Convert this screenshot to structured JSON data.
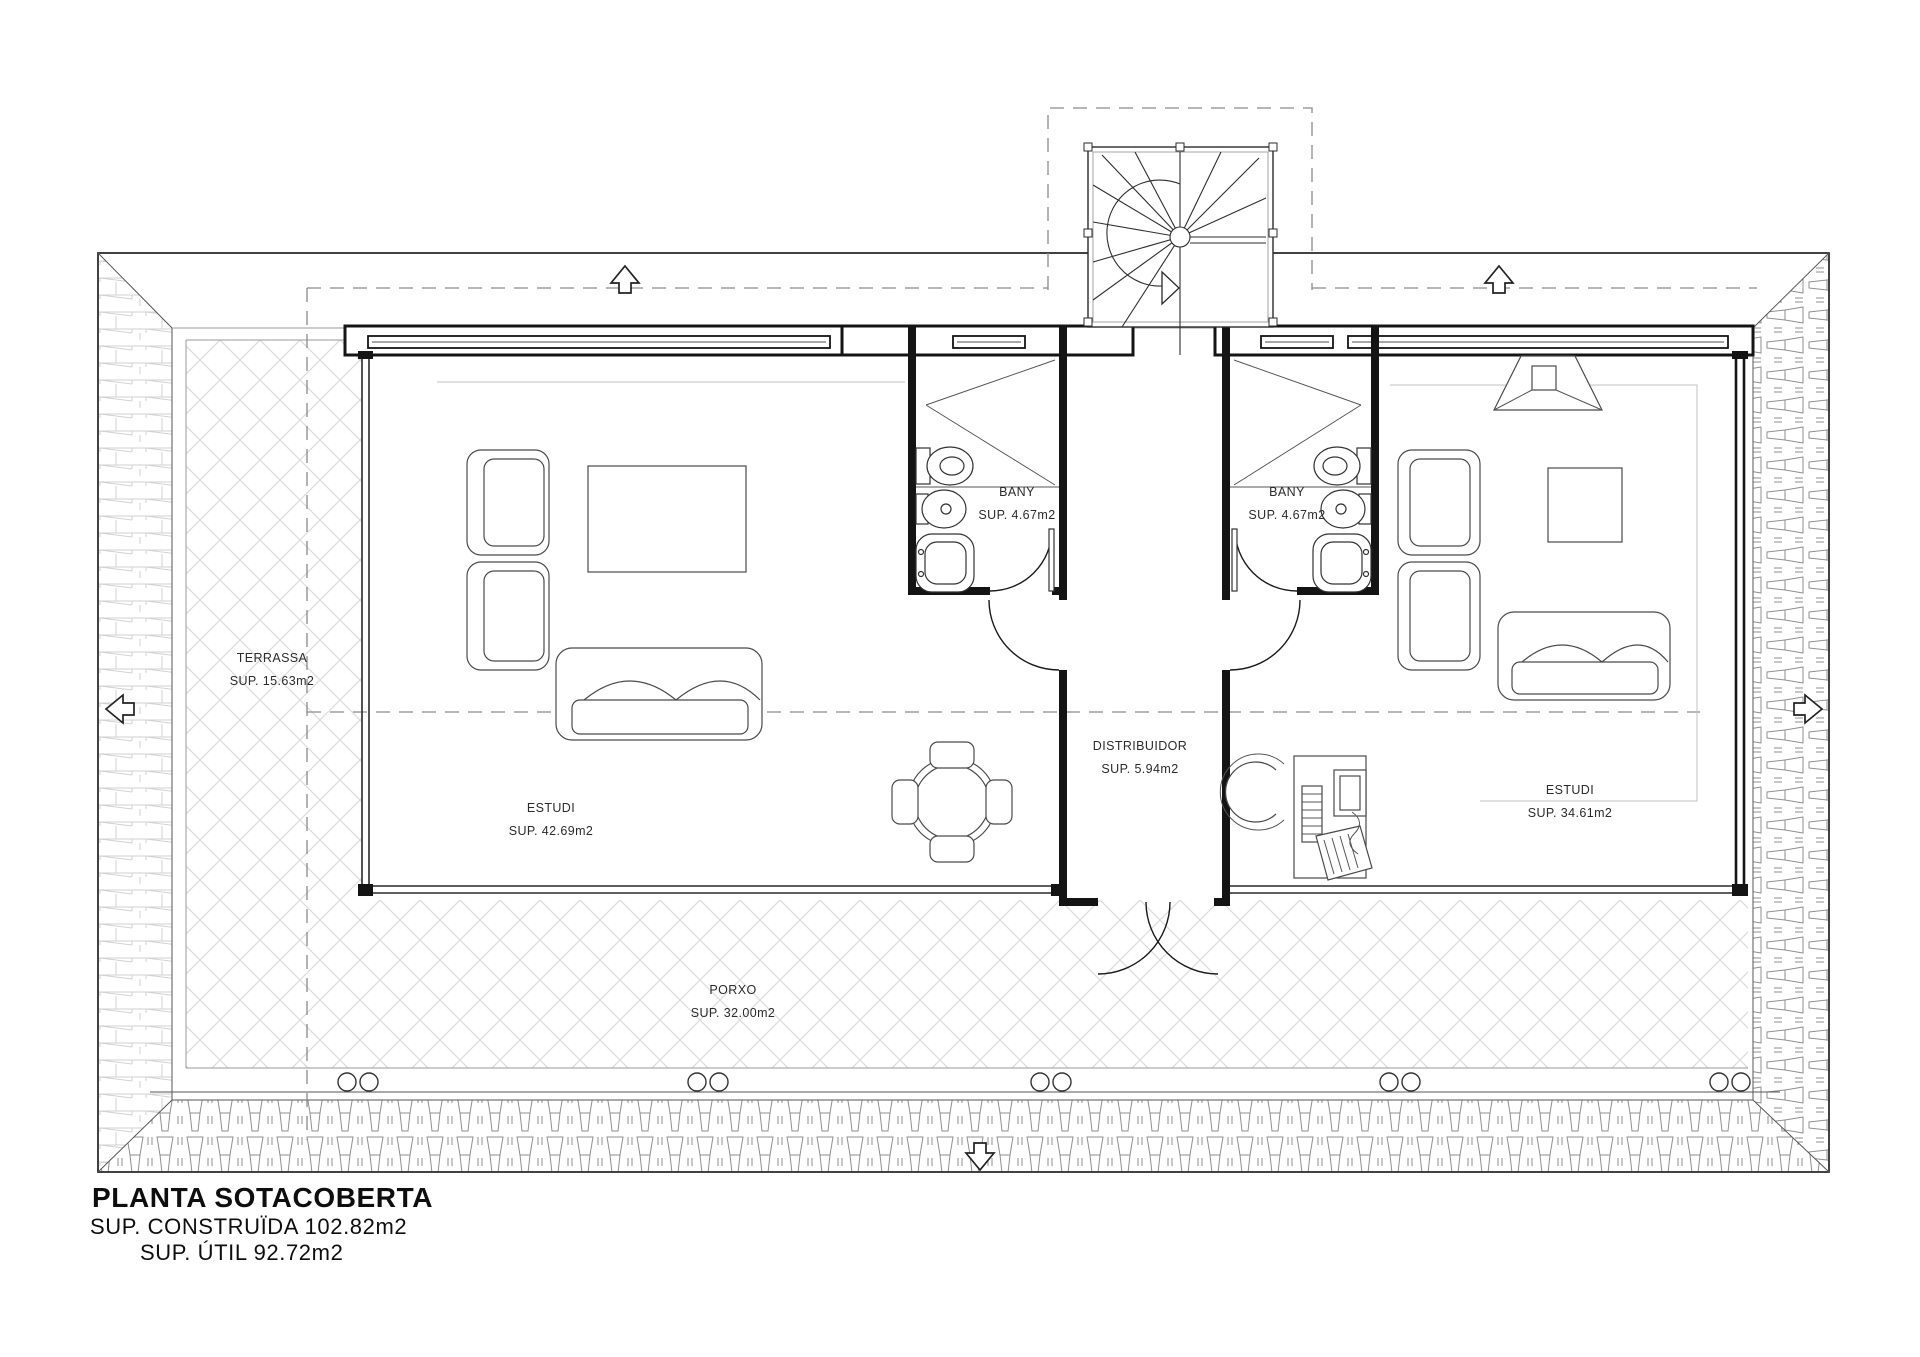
{
  "drawing": {
    "title": "PLANTA SOTACOBERTA",
    "built_area": "SUP. CONSTRUÏDA 102.82m2",
    "useful_area": "SUP. ÚTIL 92.72m2"
  },
  "rooms": {
    "terrassa": {
      "name": "TERRASSA",
      "area": "SUP. 15.63m2"
    },
    "estudi_left": {
      "name": "ESTUDI",
      "area": "SUP. 42.69m2"
    },
    "bany_left": {
      "name": "BANY",
      "area": "SUP. 4.67m2"
    },
    "distribuidor": {
      "name": "DISTRIBUIDOR",
      "area": "SUP. 5.94m2"
    },
    "bany_right": {
      "name": "BANY",
      "area": "SUP. 4.67m2"
    },
    "estudi_right": {
      "name": "ESTUDI",
      "area": "SUP. 34.61m2"
    },
    "porxo": {
      "name": "PORXO",
      "area": "SUP. 32.00m2"
    }
  },
  "colors": {
    "paper": "#ffffff",
    "line": "#1a1a1a",
    "hatch_light": "#d6d6d6",
    "roof_tile": "#8f8f8f",
    "dashed_guide": "#8a8a8a"
  }
}
